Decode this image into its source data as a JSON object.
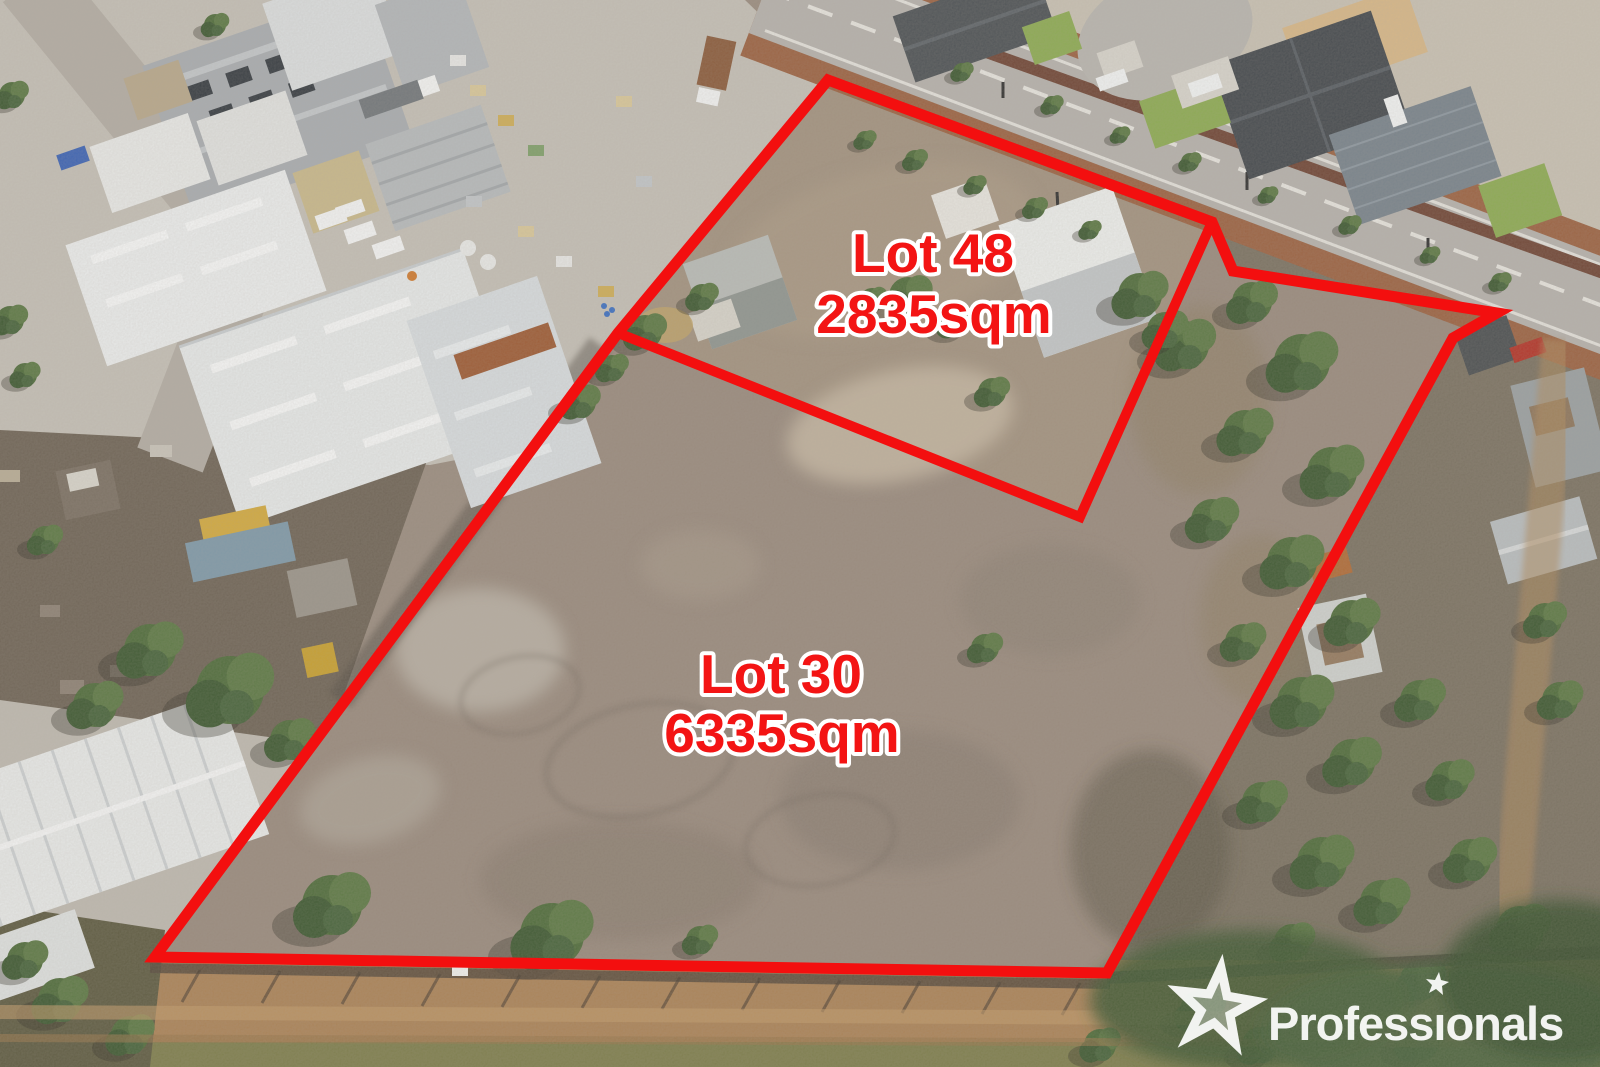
{
  "lots": [
    {
      "name": "Lot 48",
      "area": "2835sqm"
    },
    {
      "name": "Lot 30",
      "area": "6335sqm"
    }
  ],
  "boundary": {
    "color": "#f30f0f",
    "outer_points": "828,80 1212,222 1233,271 1497,313 1453,338 1107,973 155,957 618,333",
    "divider_points": "618,333 1080,517 1212,222"
  },
  "label_style": {
    "fill": "#f31414",
    "outline": "#ffffff"
  },
  "watermark": {
    "brand": "Professionals",
    "display_text": "Professıonals",
    "color": "#ffffff"
  }
}
